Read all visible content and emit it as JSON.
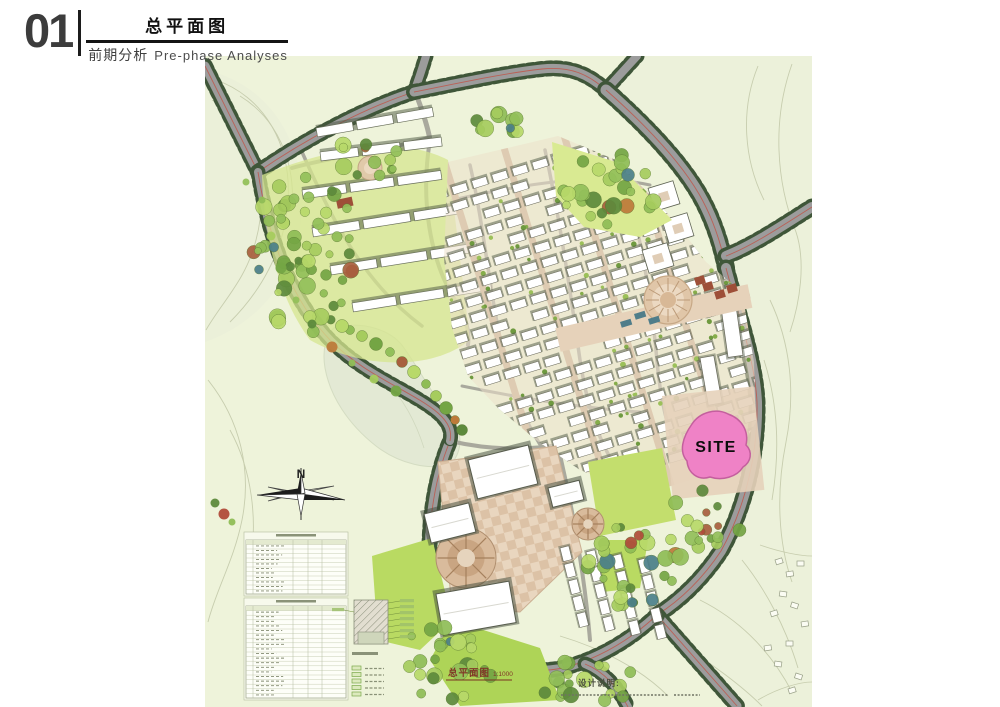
{
  "header": {
    "number": "01",
    "title": "总平面图",
    "section": "前期分析",
    "section_en": "Pre-phase Analyses"
  },
  "map": {
    "site_label": "SITE",
    "north_label": "N",
    "scale_caption": "总平面图",
    "scale_ratio": "1:1000",
    "notes_title": "设计说明:"
  },
  "colors": {
    "terrain": "#eef3da",
    "terrain_outside": "#ecf1da",
    "hill": "#e9eed8",
    "lake": "#e3e9d4",
    "contour": "#c7cdae",
    "road_gray": "#9c9c9c",
    "road_tree_green": "#3f5639",
    "red_line": "#c0564a",
    "lawn": "#b9da62",
    "paving": "#e6d2ba",
    "site_pink": "#ef82c6",
    "building_white": "#ffffff"
  }
}
